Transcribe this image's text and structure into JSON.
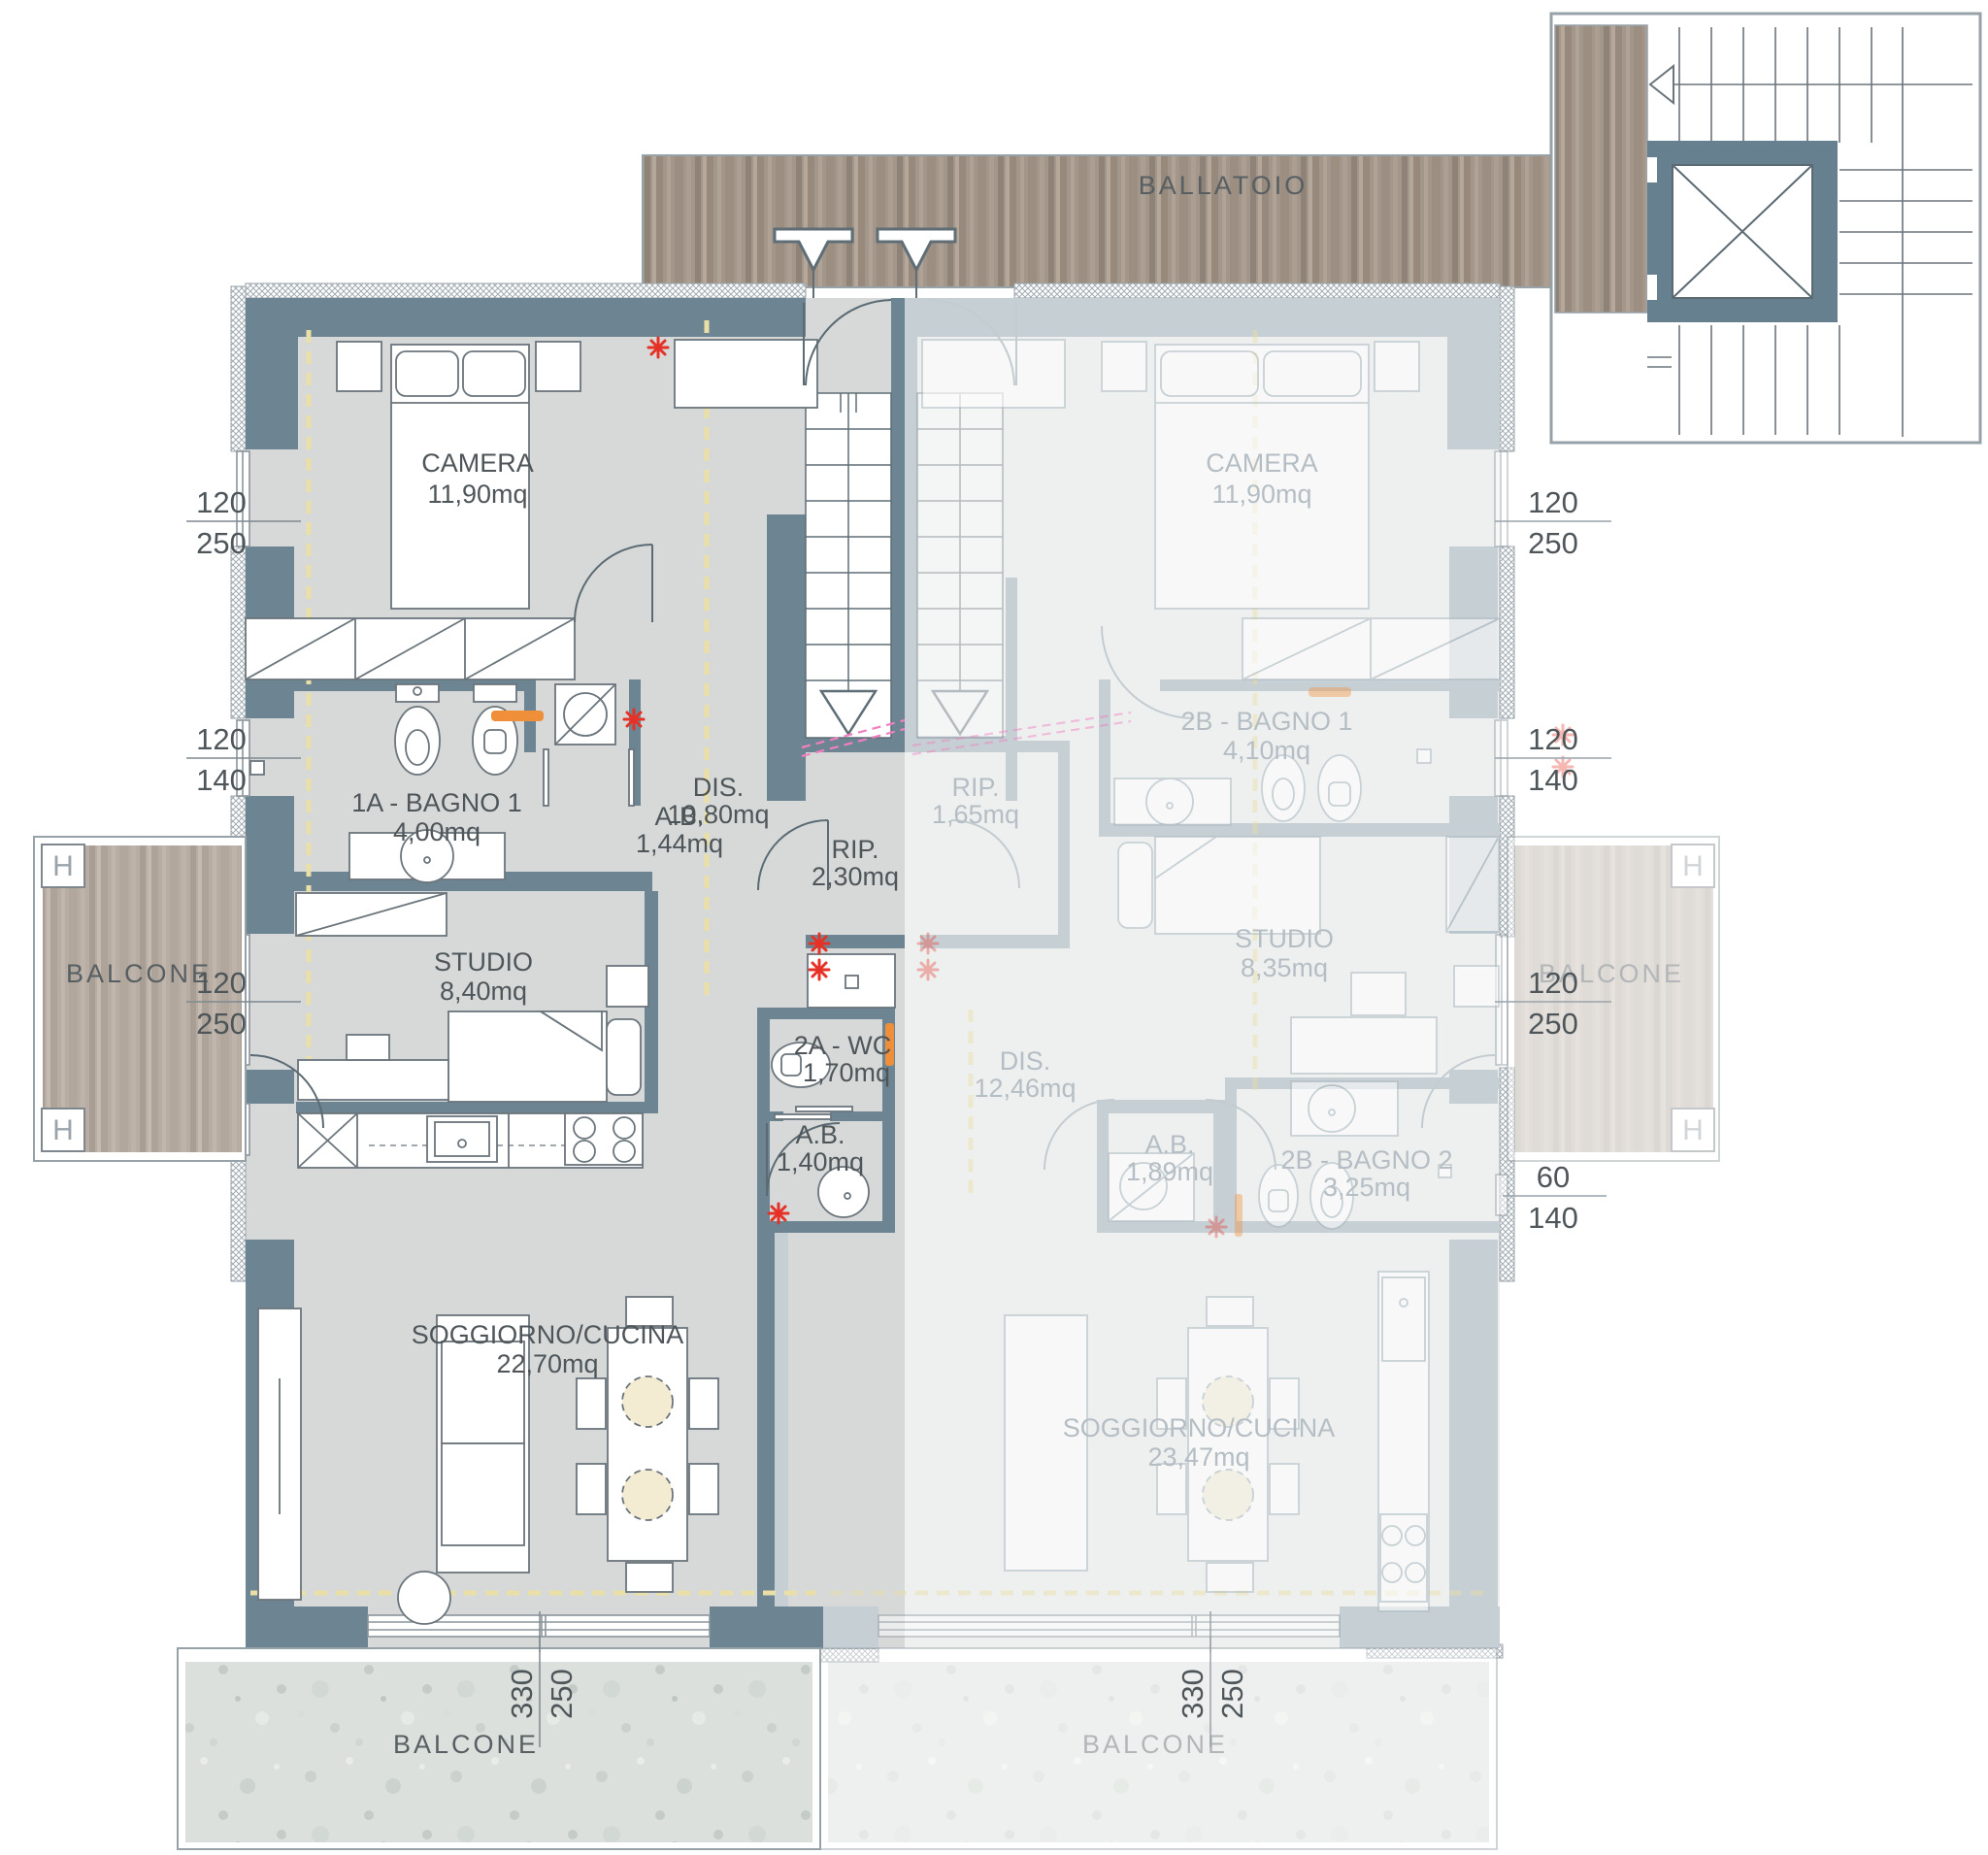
{
  "plan": {
    "circulation": {
      "ballatoio": "BALLATOIO"
    },
    "unit_left": {
      "camera": {
        "name": "CAMERA",
        "area": "11,90mq"
      },
      "bagno1": {
        "name": "1A - BAGNO 1",
        "area": "4,00mq"
      },
      "ab1": {
        "name": "A.B.",
        "area": "1,44mq"
      },
      "dis": {
        "name": "DIS.",
        "area": "10,80mq"
      },
      "rip": {
        "name": "RIP.",
        "area": "2,30mq"
      },
      "studio": {
        "name": "STUDIO",
        "area": "8,40mq"
      },
      "wc": {
        "name": "2A - WC",
        "area": "1,70mq"
      },
      "ab2": {
        "name": "A.B.",
        "area": "1,40mq"
      },
      "soggiorno": {
        "name": "SOGGIORNO/CUCINA",
        "area": "22,70mq"
      },
      "balcone_left": "BALCONE",
      "balcone_bottom": "BALCONE"
    },
    "unit_right": {
      "camera": {
        "name": "CAMERA",
        "area": "11,90mq"
      },
      "bagno1": {
        "name": "2B - BAGNO 1",
        "area": "4,10mq"
      },
      "rip": {
        "name": "RIP.",
        "area": "1,65mq"
      },
      "studio": {
        "name": "STUDIO",
        "area": "8,35mq"
      },
      "dis": {
        "name": "DIS.",
        "area": "12,46mq"
      },
      "ab": {
        "name": "A.B.",
        "area": "1,89mq"
      },
      "bagno2": {
        "name": "2B - BAGNO 2",
        "area": "3,25mq"
      },
      "soggiorno": {
        "name": "SOGGIORNO/CUCINA",
        "area": "23,47mq"
      },
      "balcone_right": "BALCONE",
      "balcone_bottom": "BALCONE"
    },
    "dims": {
      "l1t": "120",
      "l1b": "250",
      "l2t": "120",
      "l2b": "140",
      "l3t": "120",
      "l3b": "250",
      "r1t": "120",
      "r1b": "250",
      "r2t": "120",
      "r2b": "140",
      "r3t": "120",
      "r3b": "250",
      "r4t": "60",
      "r4b": "140",
      "b1t": "330",
      "b1b": "250",
      "b2t": "330",
      "b2b": "250"
    },
    "h_label": "H",
    "colors": {
      "wall_active": "#6d8492",
      "wall_faded": "#c6cfd4",
      "floor_active": "#d6d9d8",
      "floor_faded": "#eef0ef",
      "wood": "#a3968a",
      "concrete": "#dbe0dc",
      "alarm_red": "#e63226",
      "radiator_orange": "#ef8f3a",
      "cut_pink": "#ef7fc0",
      "guide_yellow": "#eadfa6"
    }
  }
}
